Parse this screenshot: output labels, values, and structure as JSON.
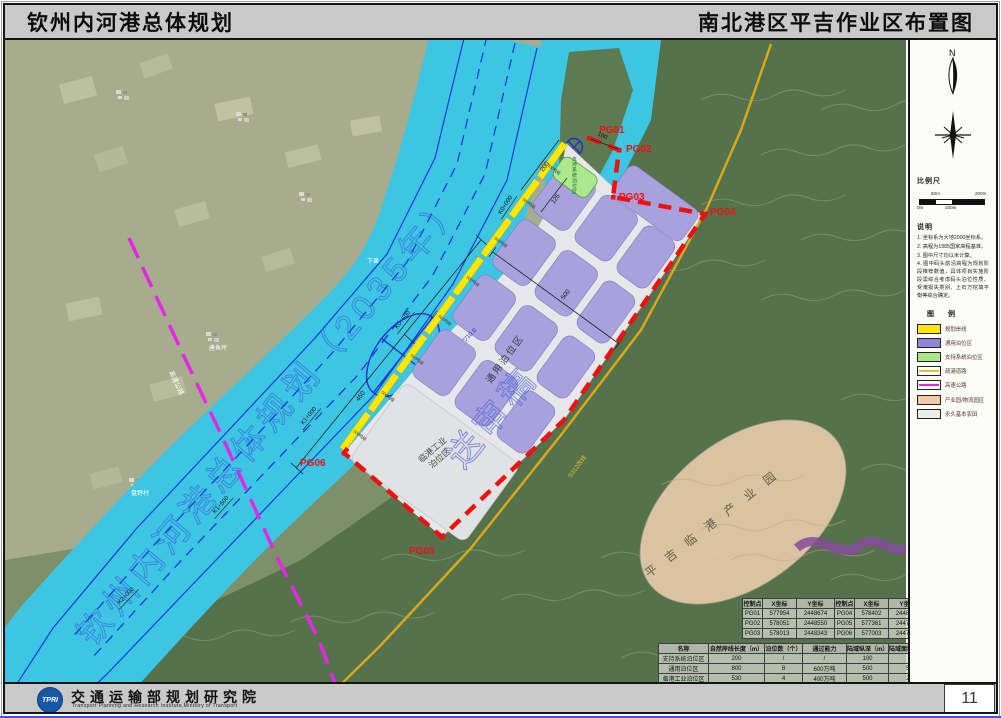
{
  "header": {
    "title_left": "钦州内河港总体规划",
    "title_right": "南北港区平吉作业区布置图"
  },
  "sidebar": {
    "compass_n": "N",
    "scale_title": "比例尺",
    "scale_ticks": [
      "50m",
      "200m",
      "0m",
      "100m"
    ],
    "notes_title": "说明",
    "notes": [
      "1. 坐标系为大地2000坐标系。",
      "2. 高程为1985国家高程基准。",
      "3. 图中尺寸均以米计算。",
      "4. 图中码头前沿高程为规划阶段推荐数值，具体项目实施阶段需综合考虑码头泊位性质、受淹损失类别、土石方挖填平衡等综合确定。"
    ],
    "legend_title": "图 例",
    "legend": [
      {
        "label": "规划岸线"
      },
      {
        "label": "通用泊位区"
      },
      {
        "label": "支持系统泊位区"
      },
      {
        "label": "疏港道路"
      },
      {
        "label": "高速公路"
      },
      {
        "label": "产业园/物流园区"
      },
      {
        "label": "永久基本农田"
      }
    ]
  },
  "map": {
    "points": [
      "PG01",
      "PG02",
      "PG03",
      "PG04",
      "PG05",
      "PG06"
    ],
    "chainage": [
      "K0+000",
      "K0+500",
      "K1+000",
      "K1+500",
      "K2+000"
    ],
    "dims": {
      "d200": "200",
      "d125": "125",
      "d100": "100",
      "d500": "500",
      "d450": "450",
      "d280": "280"
    },
    "labels": {
      "general": "通用泊位区",
      "industry1": "临港工业",
      "industry2": "泊位区",
      "support": "支持系统泊位区",
      "park": "平吉临港产业园",
      "elev": "▽10.0",
      "highway": "高速公路",
      "road": "S312改线"
    },
    "shore_class": "500吨级",
    "villages": [
      "下果",
      "唐鱼坪",
      "盘野村"
    ],
    "watermark": {
      "line1": "钦州内河港总体规划（2035年）",
      "line2": "送审稿"
    }
  },
  "tables": {
    "coords": {
      "headers": [
        "控制点",
        "X坐标",
        "Y坐标",
        "控制点",
        "X坐标",
        "Y坐标"
      ],
      "rows": [
        [
          "PG01",
          "577954",
          "2448674",
          "PG04",
          "578402",
          "2448266"
        ],
        [
          "PG02",
          "578051",
          "2448550",
          "PG05",
          "577361",
          "2447039"
        ],
        [
          "PG03",
          "578013",
          "2448343",
          "PG06",
          "577003",
          "2447388"
        ]
      ]
    },
    "stats": {
      "headers": [
        "名称",
        "自然岸线长度（m）",
        "泊位数（个）",
        "通过能力",
        "陆域纵深（m）",
        "陆域面积（万m²）"
      ],
      "rows": [
        [
          "支持系统泊位区",
          "200",
          "/",
          "/",
          "100",
          "2.3"
        ],
        [
          "通用泊位区",
          "800",
          "8",
          "600万吨",
          "500",
          "51.5"
        ],
        [
          "临港工业泊位区",
          "530",
          "4",
          "400万吨",
          "500",
          "23.3"
        ],
        [
          "合计",
          "1530",
          "12",
          "1000万吨",
          "—",
          "77.1"
        ]
      ]
    }
  },
  "footer": {
    "logo_text": "TPRI",
    "org_cn": "交通运输部规划研究院",
    "org_en": "Transport Planning and Research Institute,Ministry of Transport",
    "page": "11"
  },
  "colors": {
    "river": "#3cc6e4",
    "berth_purple": "#a9a1dd",
    "support_green": "#ace88e",
    "shoreline_yellow": "#ffe800",
    "boundary_red": "#ee1111",
    "road_gold": "#d8a818",
    "highway_magenta": "#e628e6",
    "park_peach": "#eccfae"
  }
}
